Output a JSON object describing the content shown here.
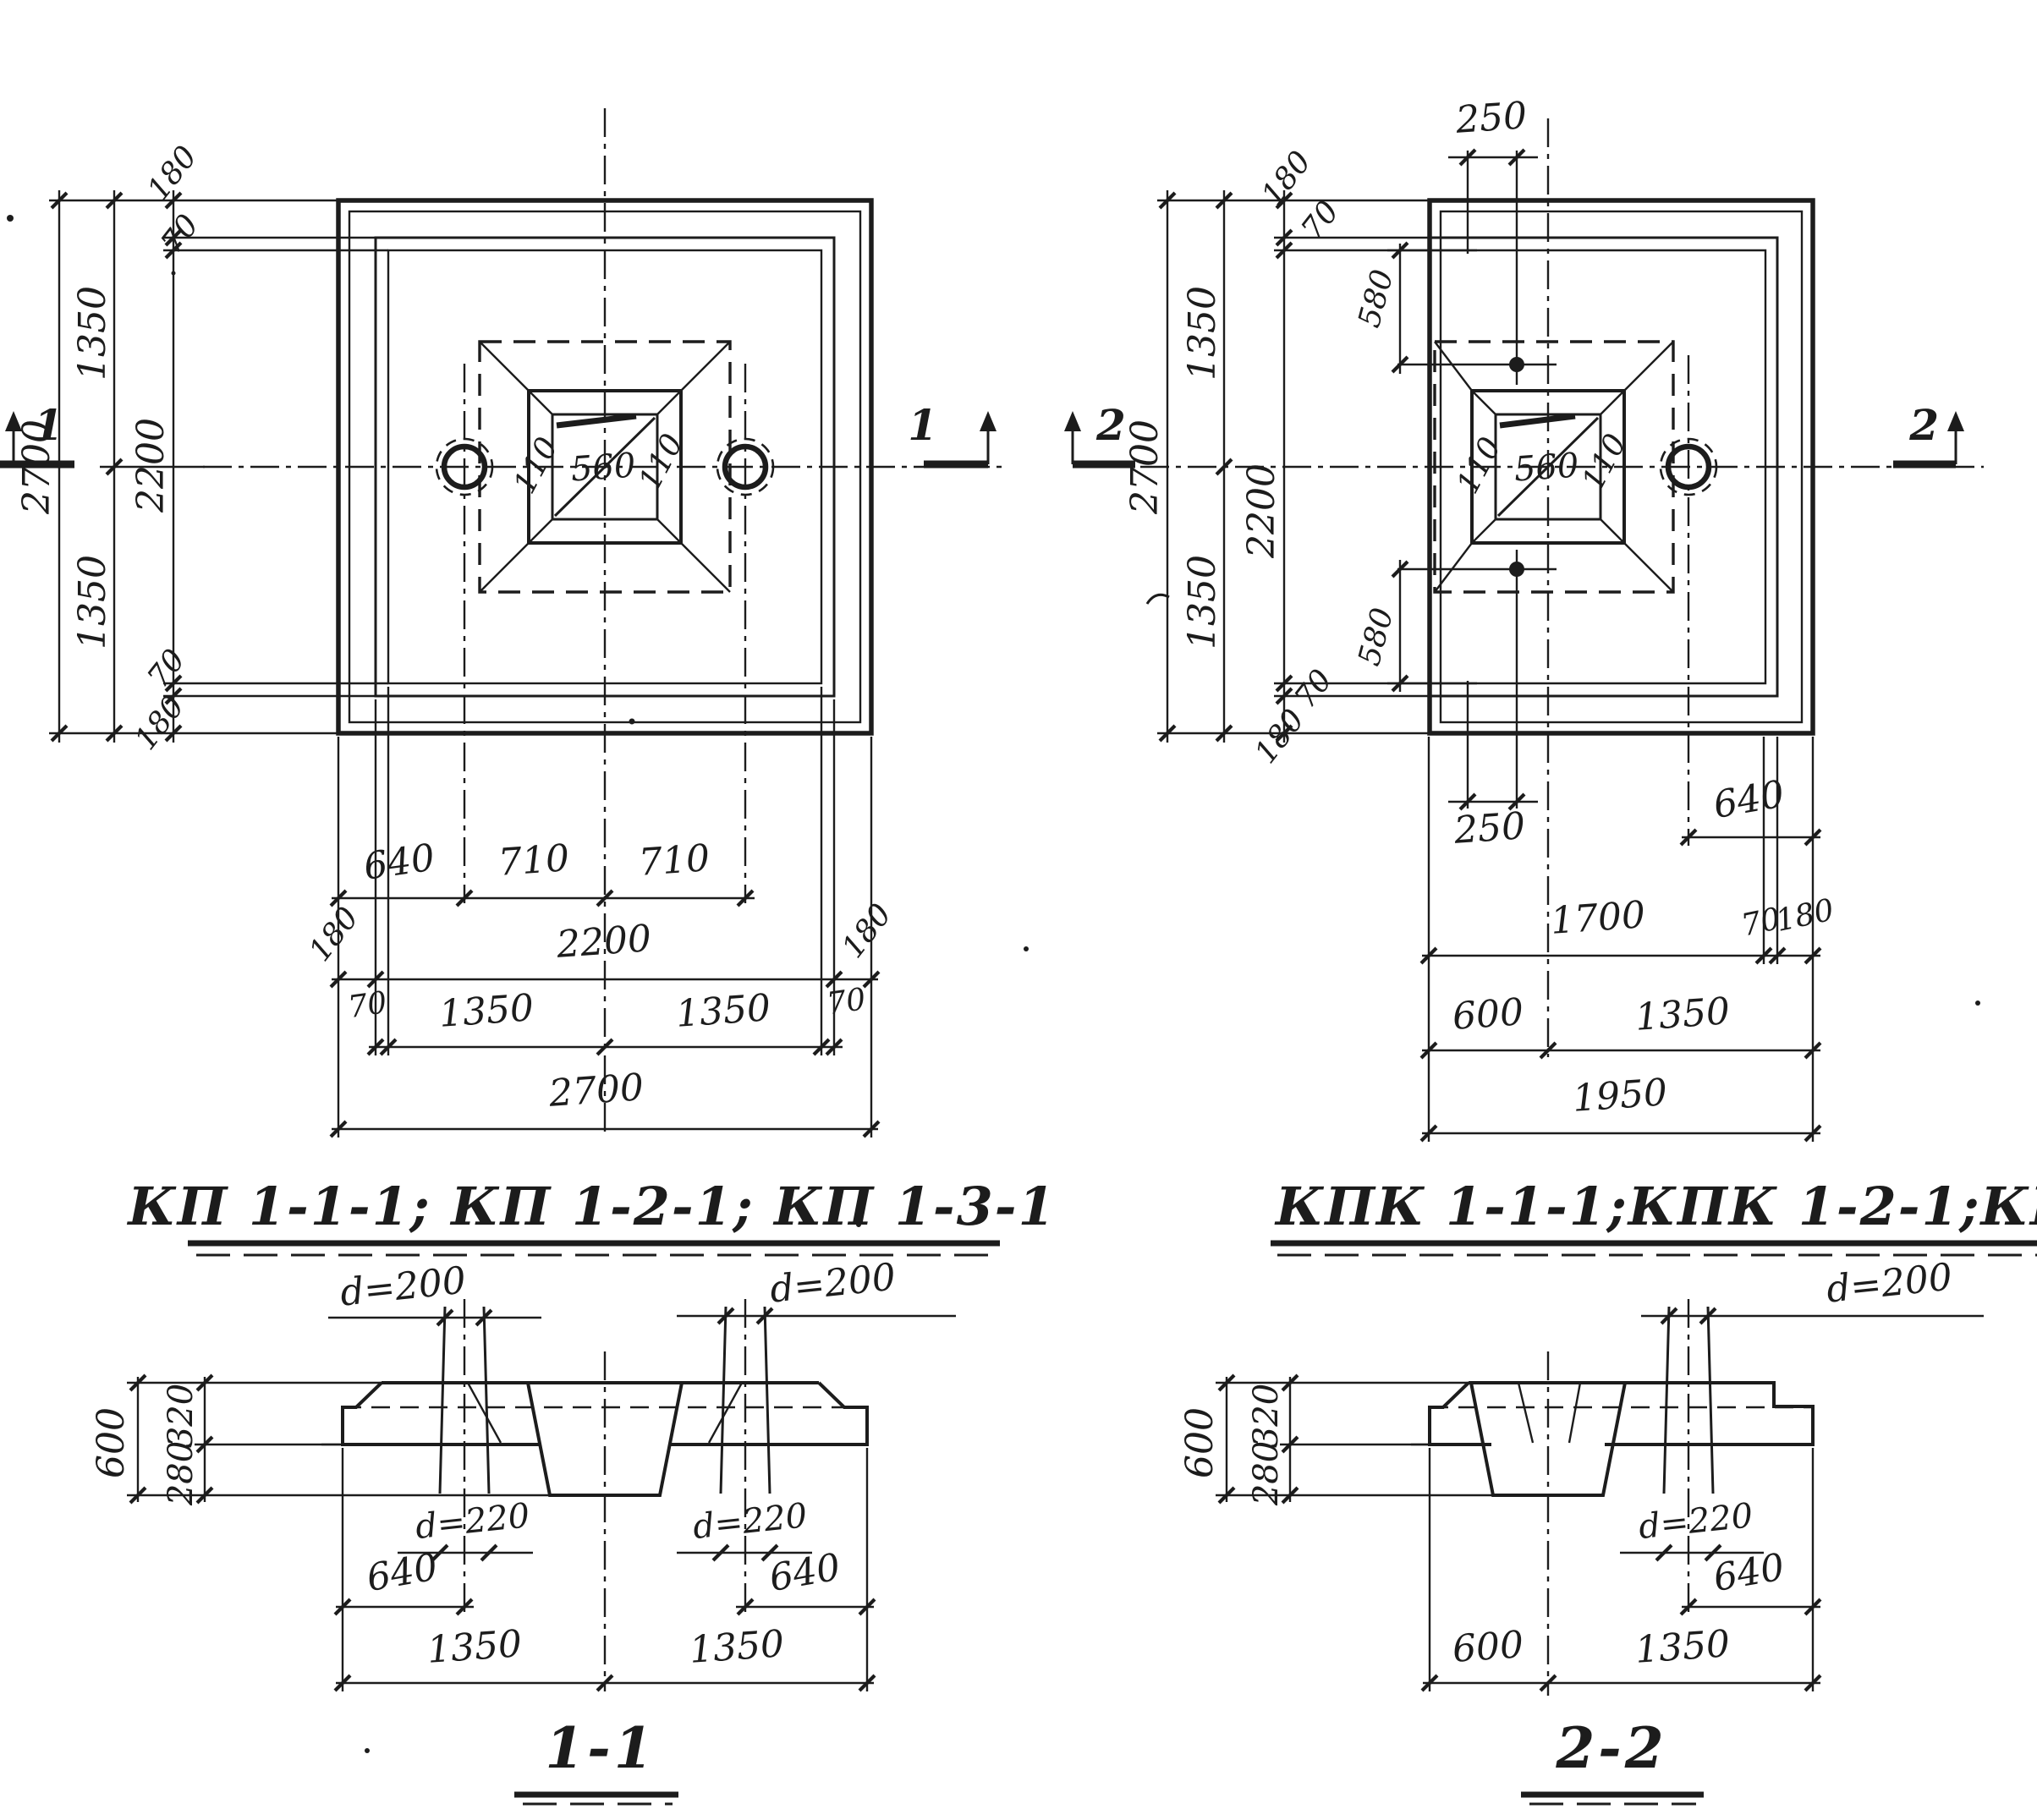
{
  "ink": "#1c1c1c",
  "plans": {
    "kp": {
      "cut": "1",
      "left": {
        "total": "2700",
        "half_top": "1350",
        "half_bot": "1350",
        "inner": "2200",
        "e_top": "180",
        "l_top": "70",
        "l_bot": "70",
        "e_bot": "180"
      },
      "socket": {
        "l": "110",
        "c": "560",
        "r": "110"
      },
      "rows": {
        "r1a": "640",
        "r1b": "710",
        "r1c": "710",
        "r2a": "180",
        "r2b": "2200",
        "r2c": "180",
        "r3a": "70",
        "r3b": "1350",
        "r3c": "1350",
        "r3d": "70",
        "r4": "2700"
      }
    },
    "kpk": {
      "cut": "2",
      "top250": "250",
      "bot250": "250",
      "hole_top": "580",
      "hole_bot": "580",
      "left": {
        "total": "2700",
        "half_top": "1350",
        "half_bot": "1350",
        "inner": "2200",
        "e_top": "180",
        "l_top": "70",
        "l_bot": "70",
        "e_bot": "180"
      },
      "socket": {
        "l": "110",
        "c": "560",
        "r": "110"
      },
      "rows": {
        "r1": "640",
        "r2a": "1700",
        "r2b": "70",
        "r2c": "180",
        "r3a": "600",
        "r3b": "1350",
        "r4": "1950"
      }
    }
  },
  "titles": {
    "kp": "КП 1-1-1; КП 1-2-1; КП 1-3-1",
    "kpk": "КПК 1-1-1;КПК 1-2-1;КПК 1-3-1"
  },
  "sections": {
    "s1": {
      "label": "1-1",
      "d_top_l": "d=200",
      "d_top_r": "d=200",
      "h": "600",
      "h1": "320",
      "h2": "280",
      "d_bot_l": "d=220",
      "d_bot_r": "d=220",
      "off_l": "640",
      "off_r": "640",
      "w_l": "1350",
      "w_r": "1350"
    },
    "s2": {
      "label": "2-2",
      "d_top": "d=200",
      "h": "600",
      "h1": "320",
      "h2": "280",
      "d_bot": "d=220",
      "off": "640",
      "w_a": "600",
      "w_b": "1350"
    }
  }
}
